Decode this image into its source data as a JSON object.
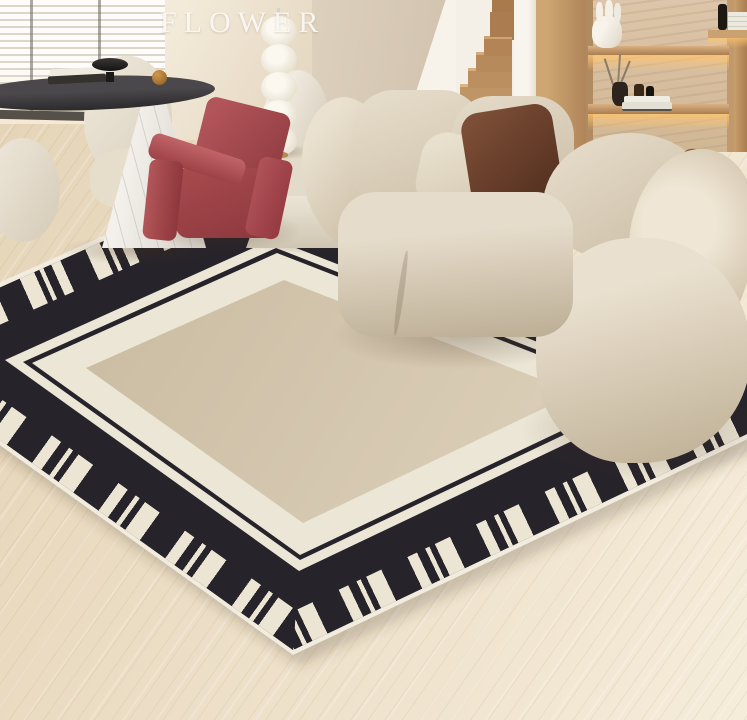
{
  "watermark": {
    "text": "FLOWER"
  },
  "palette": {
    "rug_black": "#26232a",
    "rug_stripe_cream": "#ece5d4",
    "rug_white_band": "#ece6d6",
    "rug_center_beige": "#d3c6ae",
    "rug_binding": "#f2ecdf",
    "floor_wood": "#ead9be",
    "wall_warm": "#ecdfcc",
    "wall_greige": "#d6c9b6",
    "stair_wood": "#c0955f",
    "shelf_travertine": "#d9c2a6",
    "led_glow": "#ffc46e",
    "sofa_boucle": "#ddd3c0",
    "pillow_brown": "#5d3422",
    "pillow_rust": "#7a4631",
    "accent_chair_red": "#a84a4c",
    "table_top_charcoal": "#3a393b",
    "marble_base": "#f2efec",
    "lamp_white": "#f6f1e6"
  },
  "scene": {
    "setting": "living room with staircase and built-in shelving",
    "objects": [
      "venetian blinds",
      "round charcoal dining table",
      "marble cone table base",
      "white sculptural dining chairs",
      "stacked-sphere floor lamp",
      "red utrecht armchair",
      "beige boucle sofa",
      "brown velvet pillow",
      "rust pillow",
      "black and white graphic border rug",
      "light wood floor",
      "wooden staircase",
      "travertine shelf niche with led lighting",
      "white coral sculpture vase",
      "vase with dried branches",
      "stacked books",
      "perfume bottles"
    ]
  }
}
